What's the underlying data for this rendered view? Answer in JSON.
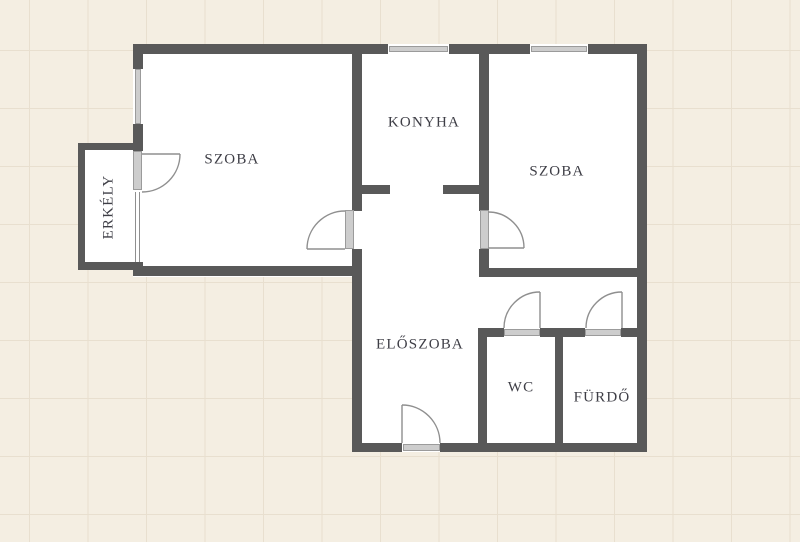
{
  "plan": {
    "type": "apartment-floor-plan",
    "background_color": "#f4eee2",
    "grid_color": "#e8dfcf",
    "wall_color": "#595959",
    "room_fill": "#ffffff",
    "fixture_fill": "#cdcdcd",
    "symbol_line_color": "#8f8f8f",
    "label_color": "#3e3e46",
    "rooms": [
      {
        "id": "szoba-left",
        "label": "SZOBA"
      },
      {
        "id": "konyha",
        "label": "KONYHA"
      },
      {
        "id": "szoba-right",
        "label": "SZOBA"
      },
      {
        "id": "erkely",
        "label": "ERKÉLY"
      },
      {
        "id": "eloszoba",
        "label": "ELŐSZOBA"
      },
      {
        "id": "wc",
        "label": "WC"
      },
      {
        "id": "furdo",
        "label": "FÜRDŐ"
      }
    ]
  }
}
